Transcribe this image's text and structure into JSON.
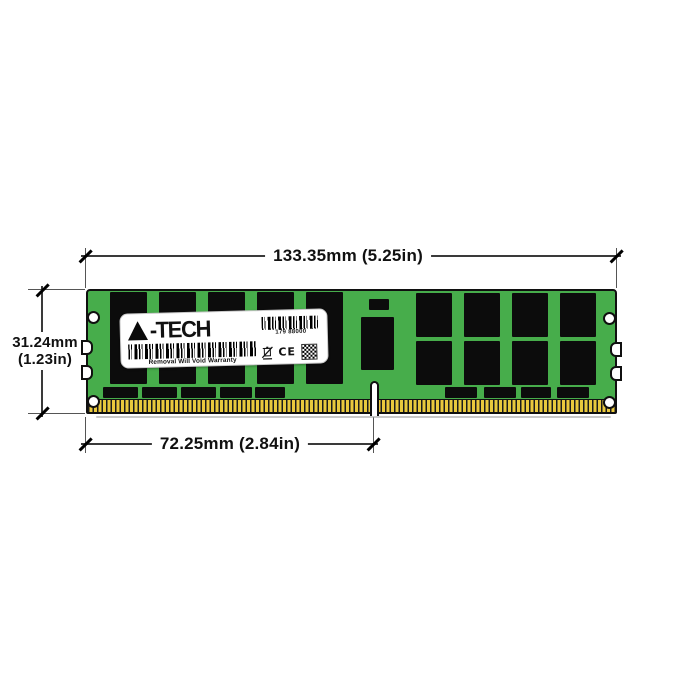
{
  "diagram": {
    "subject": "A-Tech DDR4 LRDIMM memory module dimensional diagram",
    "dims": {
      "width": {
        "label": "133.35mm (5.25in)"
      },
      "height": {
        "line1": "31.24mm",
        "line2": "(1.23in)"
      },
      "pins": {
        "label": "72.25mm (2.84in)"
      }
    }
  },
  "label": {
    "brand": "A-TECH",
    "brand_suffix": "-TECH",
    "serial": "179 88000",
    "warranty": "Removal Will Void Warranty",
    "ce": "CE"
  },
  "icons": {
    "weee": "crossed-out-wheelie-bin",
    "qr": "qr-code",
    "serial_barcode": "barcode",
    "main_barcode": "barcode"
  },
  "colors": {
    "pcb_green": "#47ad4b",
    "chip_black": "#0c0c0c",
    "pin_gold": "#eac93d",
    "outline": "#101010",
    "background": "#ffffff"
  }
}
